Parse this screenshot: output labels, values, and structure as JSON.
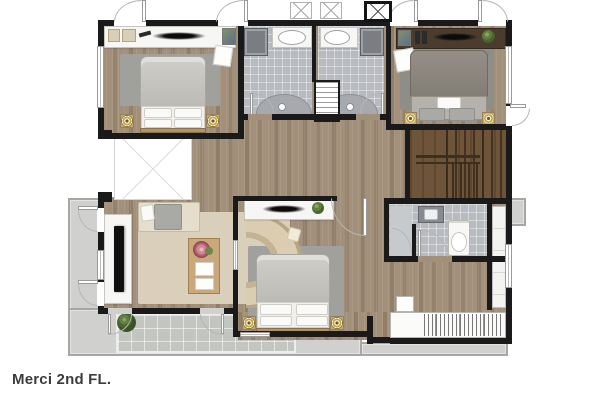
{
  "caption": {
    "text": "Merci 2nd FL."
  },
  "palette": {
    "wall": "#1a1a1a",
    "wood": "#a2907a",
    "woodDark": "#6e5539",
    "tile": "#b7bbbf",
    "tileLight": "#c6cacd",
    "balcony": "#d0d0ce",
    "balconyEdge": "#a6a6a4",
    "deck": "#c3c5c1",
    "rugGray": "#a0a09c",
    "rugDark": "#8f8d88",
    "rugBeige": "#d9cfba",
    "sheet": "#f1f0ec",
    "consoleWhite": "#f6f6f4",
    "consoleDark": "#4b3c2e",
    "tableWood": "#c9a87b",
    "gold": "#c9a43d",
    "arc": "#b5b5b5",
    "captionColor": "#3c3c3c"
  },
  "floorplan": {
    "floor_label": "Merci 2nd FL.",
    "rooms": [
      "bedroom-top-left",
      "shared-bathroom-left",
      "shared-bathroom-right",
      "linen-closet",
      "bedroom-top-right",
      "stairs",
      "hallway",
      "void-open-to-below",
      "living-area",
      "bedroom-bottom",
      "ensuite-bathroom",
      "wardrobe",
      "balcony-left",
      "terrace-bottom",
      "balcony-ledge-right"
    ]
  }
}
